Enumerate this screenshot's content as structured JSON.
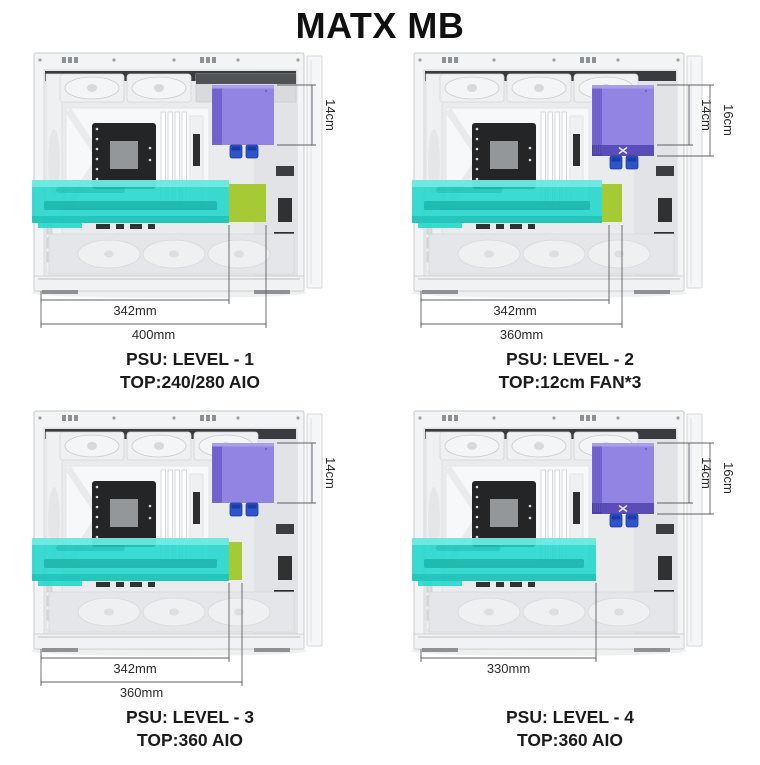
{
  "title": "MATX MB",
  "colors": {
    "psu_purple": "#9184e3",
    "psu_band_purple": "#5b4db7",
    "gpu_teal": "rgba(32,214,203,0.88)",
    "clearance_green": "#a6ca35",
    "connector_blue": "#2e54cb",
    "dim_line": "#5d6165"
  },
  "panels": [
    {
      "psu_label": "PSU: LEVEL - 1",
      "top_label": "TOP:240/280 AIO",
      "top_fans": 2,
      "psu_extended": false,
      "gpu_end": 225,
      "green_end": 262,
      "side_dims": [
        {
          "label": "14cm"
        }
      ],
      "bottom_dims": [
        {
          "label": "342mm",
          "end": 225
        },
        {
          "label": "400mm",
          "end": 262
        }
      ]
    },
    {
      "psu_label": "PSU: LEVEL - 2",
      "top_label": "TOP:12cm FAN*3",
      "top_fans": 3,
      "psu_extended": true,
      "gpu_end": 218,
      "green_end": 238,
      "side_dims": [
        {
          "label": "14cm"
        },
        {
          "label": "16cm"
        }
      ],
      "bottom_dims": [
        {
          "label": "342mm",
          "end": 225
        },
        {
          "label": "360mm",
          "end": 238
        }
      ]
    },
    {
      "psu_label": "PSU: LEVEL - 3",
      "top_label": "TOP:360 AIO",
      "top_fans": 3,
      "psu_extended": false,
      "gpu_end": 225,
      "green_end": 238,
      "side_dims": [
        {
          "label": "14cm"
        }
      ],
      "bottom_dims": [
        {
          "label": "342mm",
          "end": 225
        },
        {
          "label": "360mm",
          "end": 238
        }
      ]
    },
    {
      "psu_label": "PSU: LEVEL - 4",
      "top_label": "TOP:360 AIO",
      "top_fans": 3,
      "psu_extended": true,
      "gpu_end": 212,
      "green_end": null,
      "side_dims": [
        {
          "label": "14cm"
        },
        {
          "label": "16cm"
        }
      ],
      "bottom_dims": [
        {
          "label": "330mm",
          "end": 212
        }
      ]
    }
  ]
}
